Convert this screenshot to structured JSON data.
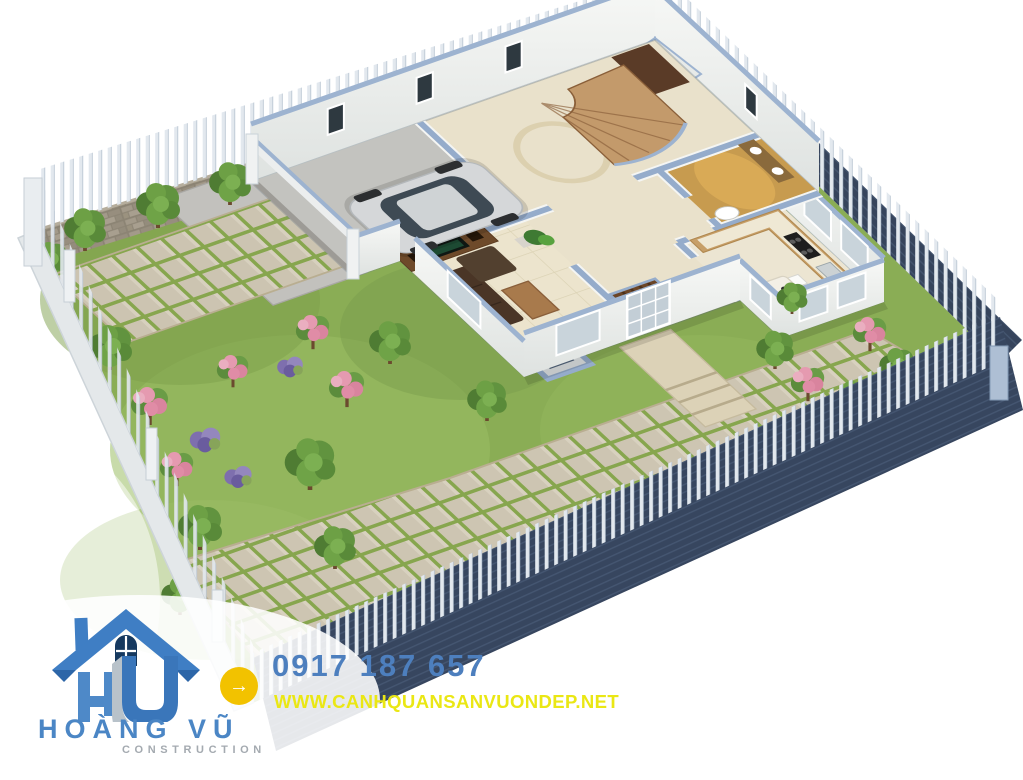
{
  "brand": {
    "name": "HOÀNG VŨ",
    "division": "CONSTRUCTION",
    "name_color": "#4b86c5",
    "division_color": "#a4aab0",
    "logo_roof_blue": "#3f7ec4",
    "logo_roof_dark": "#2d66a8",
    "logo_monogram_blue": "#4e89c8",
    "logo_monogram_3d_blue": "#3a76ba",
    "logo_monogram_gray": "#b8c2ca",
    "logo_window_navy": "#16395f"
  },
  "contact": {
    "phone": "0917 187 657",
    "website": "WWW.CANHQUANSANVUONDEP.NET",
    "phone_color": "#4d7fbe",
    "website_color": "#eae714",
    "badge_color": "#f2c200"
  },
  "icons": {
    "arrow_icon": "→",
    "logo_house_icon": "house-with-hu-monogram"
  },
  "scene": {
    "type": "3d-landscape-architecture-render",
    "palette": {
      "grass": "#8aad55",
      "paver": "#cdc5b2",
      "paver_joint": "#87a64e",
      "driveway": "#c2c1bd",
      "fence_picket": "#e2e8ee",
      "fence_navy": "#3a4964",
      "stone_wall": "#998f7e",
      "wall_white": "#f6f7f5",
      "wall_cap_blue": "#98afcc",
      "stair_wood": "#c39a6b",
      "tv_wall_wood": "#6e4a2a",
      "bathroom_gold": "#c79b4f",
      "car_silver": "#d5d7d9"
    }
  }
}
